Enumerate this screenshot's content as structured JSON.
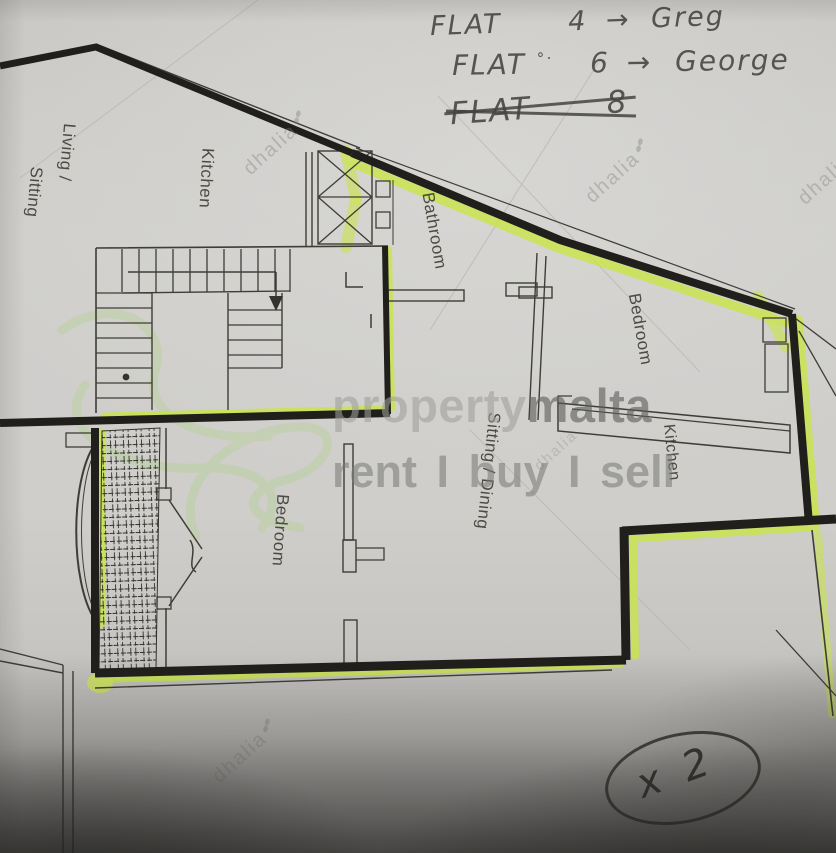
{
  "handwriting": {
    "lines": [
      {
        "label": "FLAT",
        "mark": "",
        "number": "4",
        "arrow": "→",
        "name": "Greg"
      },
      {
        "label": "FLAT",
        "mark": "°·",
        "number": "6",
        "arrow": "→",
        "name": "George"
      },
      {
        "label": "FLAT",
        "mark": "",
        "number": "8",
        "arrow": "",
        "name": ""
      }
    ],
    "multiplier": "x 2"
  },
  "floorplan": {
    "labels": {
      "living1": "Living /",
      "living2": "Sitting",
      "kitchen_upper": "Kitchen",
      "bathroom": "Bathroom",
      "bedroom_upper": "Bedroom",
      "kitchen_lower": "Kitchen",
      "sitting_dining": "Sitting / Dining",
      "bedroom_lower": "Bedroom"
    }
  },
  "watermark": {
    "brand_light": "property",
    "brand_dark": "malta",
    "tagline": "rent I buy I sell",
    "agency": "dhalia"
  },
  "colors": {
    "paper": "#cfcecb",
    "wall": "#201f1b",
    "pencil": "#3f3d37",
    "highlighter": "#c9e546",
    "logo_green": "#aacf7e",
    "watermark_gray": "#8e8e8b",
    "ink": "#45433f"
  }
}
